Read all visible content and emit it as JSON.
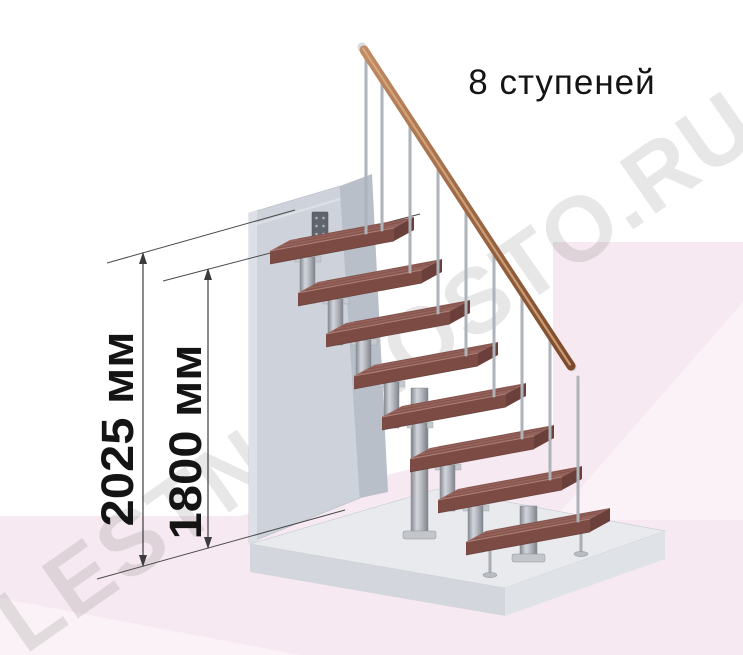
{
  "title": "8 ступеней",
  "dimensions": {
    "total": {
      "label": "2025 мм",
      "value": 2025,
      "unit": "мм"
    },
    "flight": {
      "label": "1800 мм",
      "value": 1800,
      "unit": "мм"
    }
  },
  "watermark": "LESTNIPROSTO.RU",
  "staircase": {
    "steps_count": 8,
    "steps_count_source": "title"
  },
  "colors": {
    "background": "#ffffff",
    "background_pink": "#f7e9f1",
    "wood_tread_top": "#915f57",
    "wood_tread_front": "#7c4b44",
    "metal_gray": "#b3b7bd",
    "wall_gray": "#ced2da",
    "floor_gray": "#e8eaee",
    "handrail_copper": "#a06b46",
    "dimension_line": "#3c3c3c",
    "text": "#141414",
    "watermark_gray": "#e4e4e4"
  }
}
